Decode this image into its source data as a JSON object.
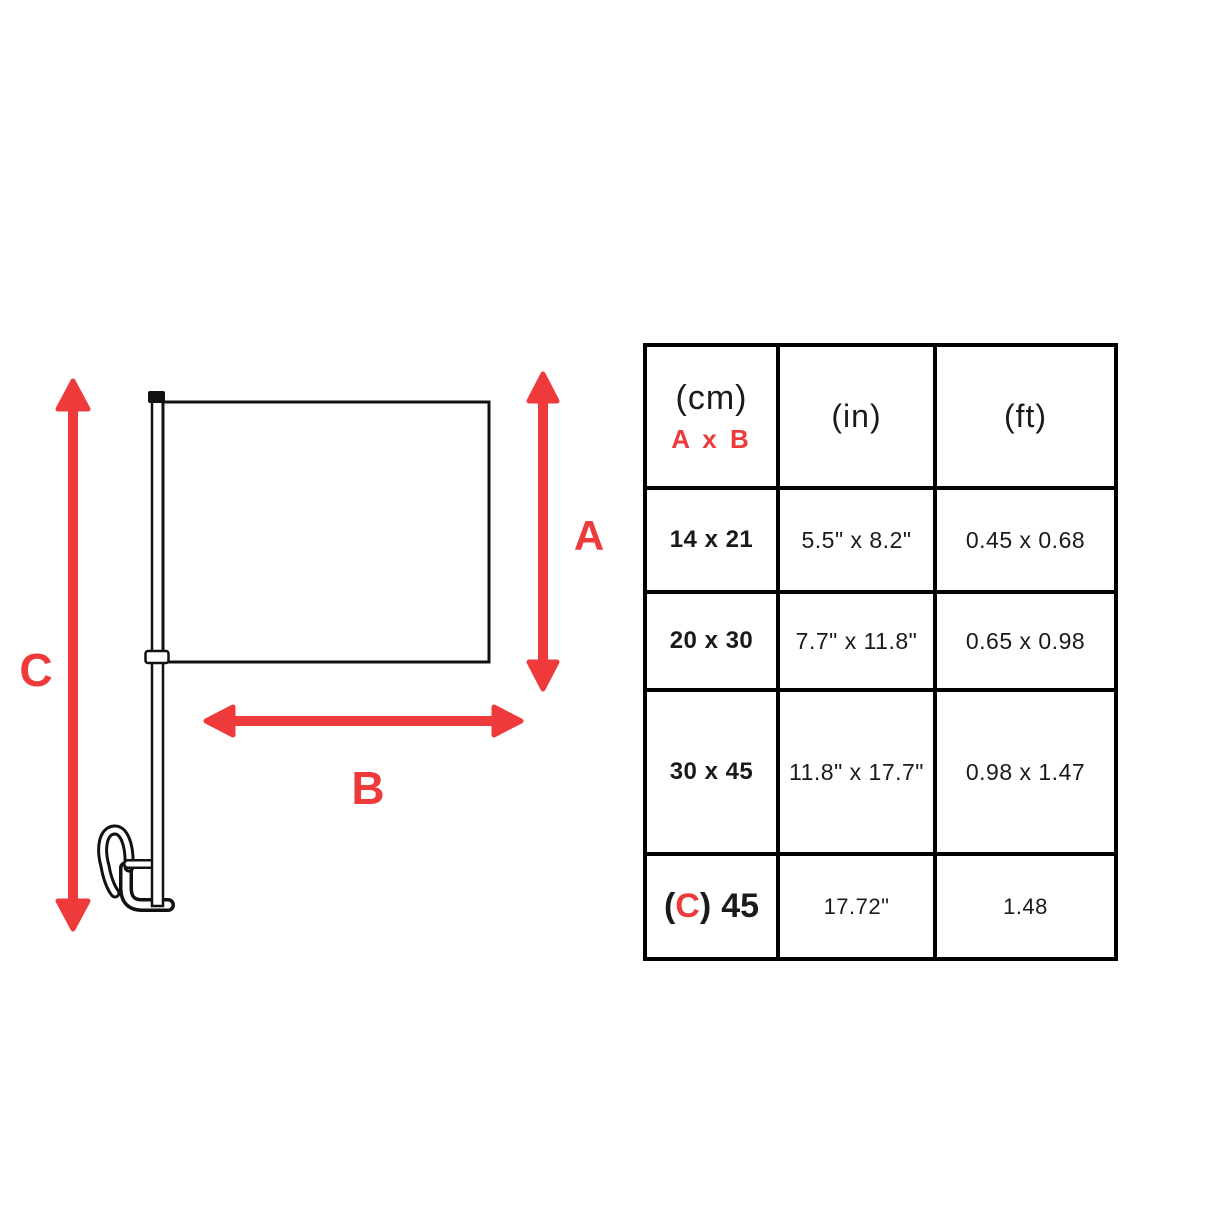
{
  "diagram": {
    "labels": {
      "a": "A",
      "b": "B",
      "c": "C"
    },
    "arrow_color": "#ee3a3b",
    "line_color": "#111111",
    "flag_fill": "#ffffff"
  },
  "table": {
    "header": {
      "unit_cm": "(cm)",
      "dims": "A x B",
      "unit_in": "(in)",
      "unit_ft": "(ft)"
    },
    "rows": [
      {
        "cm": "14 x 21",
        "inch": "5.5\" x 8.2\"",
        "ft": "0.45 x 0.68"
      },
      {
        "cm": "20 x 30",
        "inch": "7.7\" x 11.8\"",
        "ft": "0.65 x 0.98"
      },
      {
        "cm": "30 x 45",
        "inch": "11.8\" x 17.7\"",
        "ft": "0.98 x 1.47"
      }
    ],
    "last_row": {
      "open_paren": "(",
      "c_label": "C",
      "close_paren": ")",
      "value": "45",
      "inch": "17.72\"",
      "ft": "1.48"
    }
  }
}
